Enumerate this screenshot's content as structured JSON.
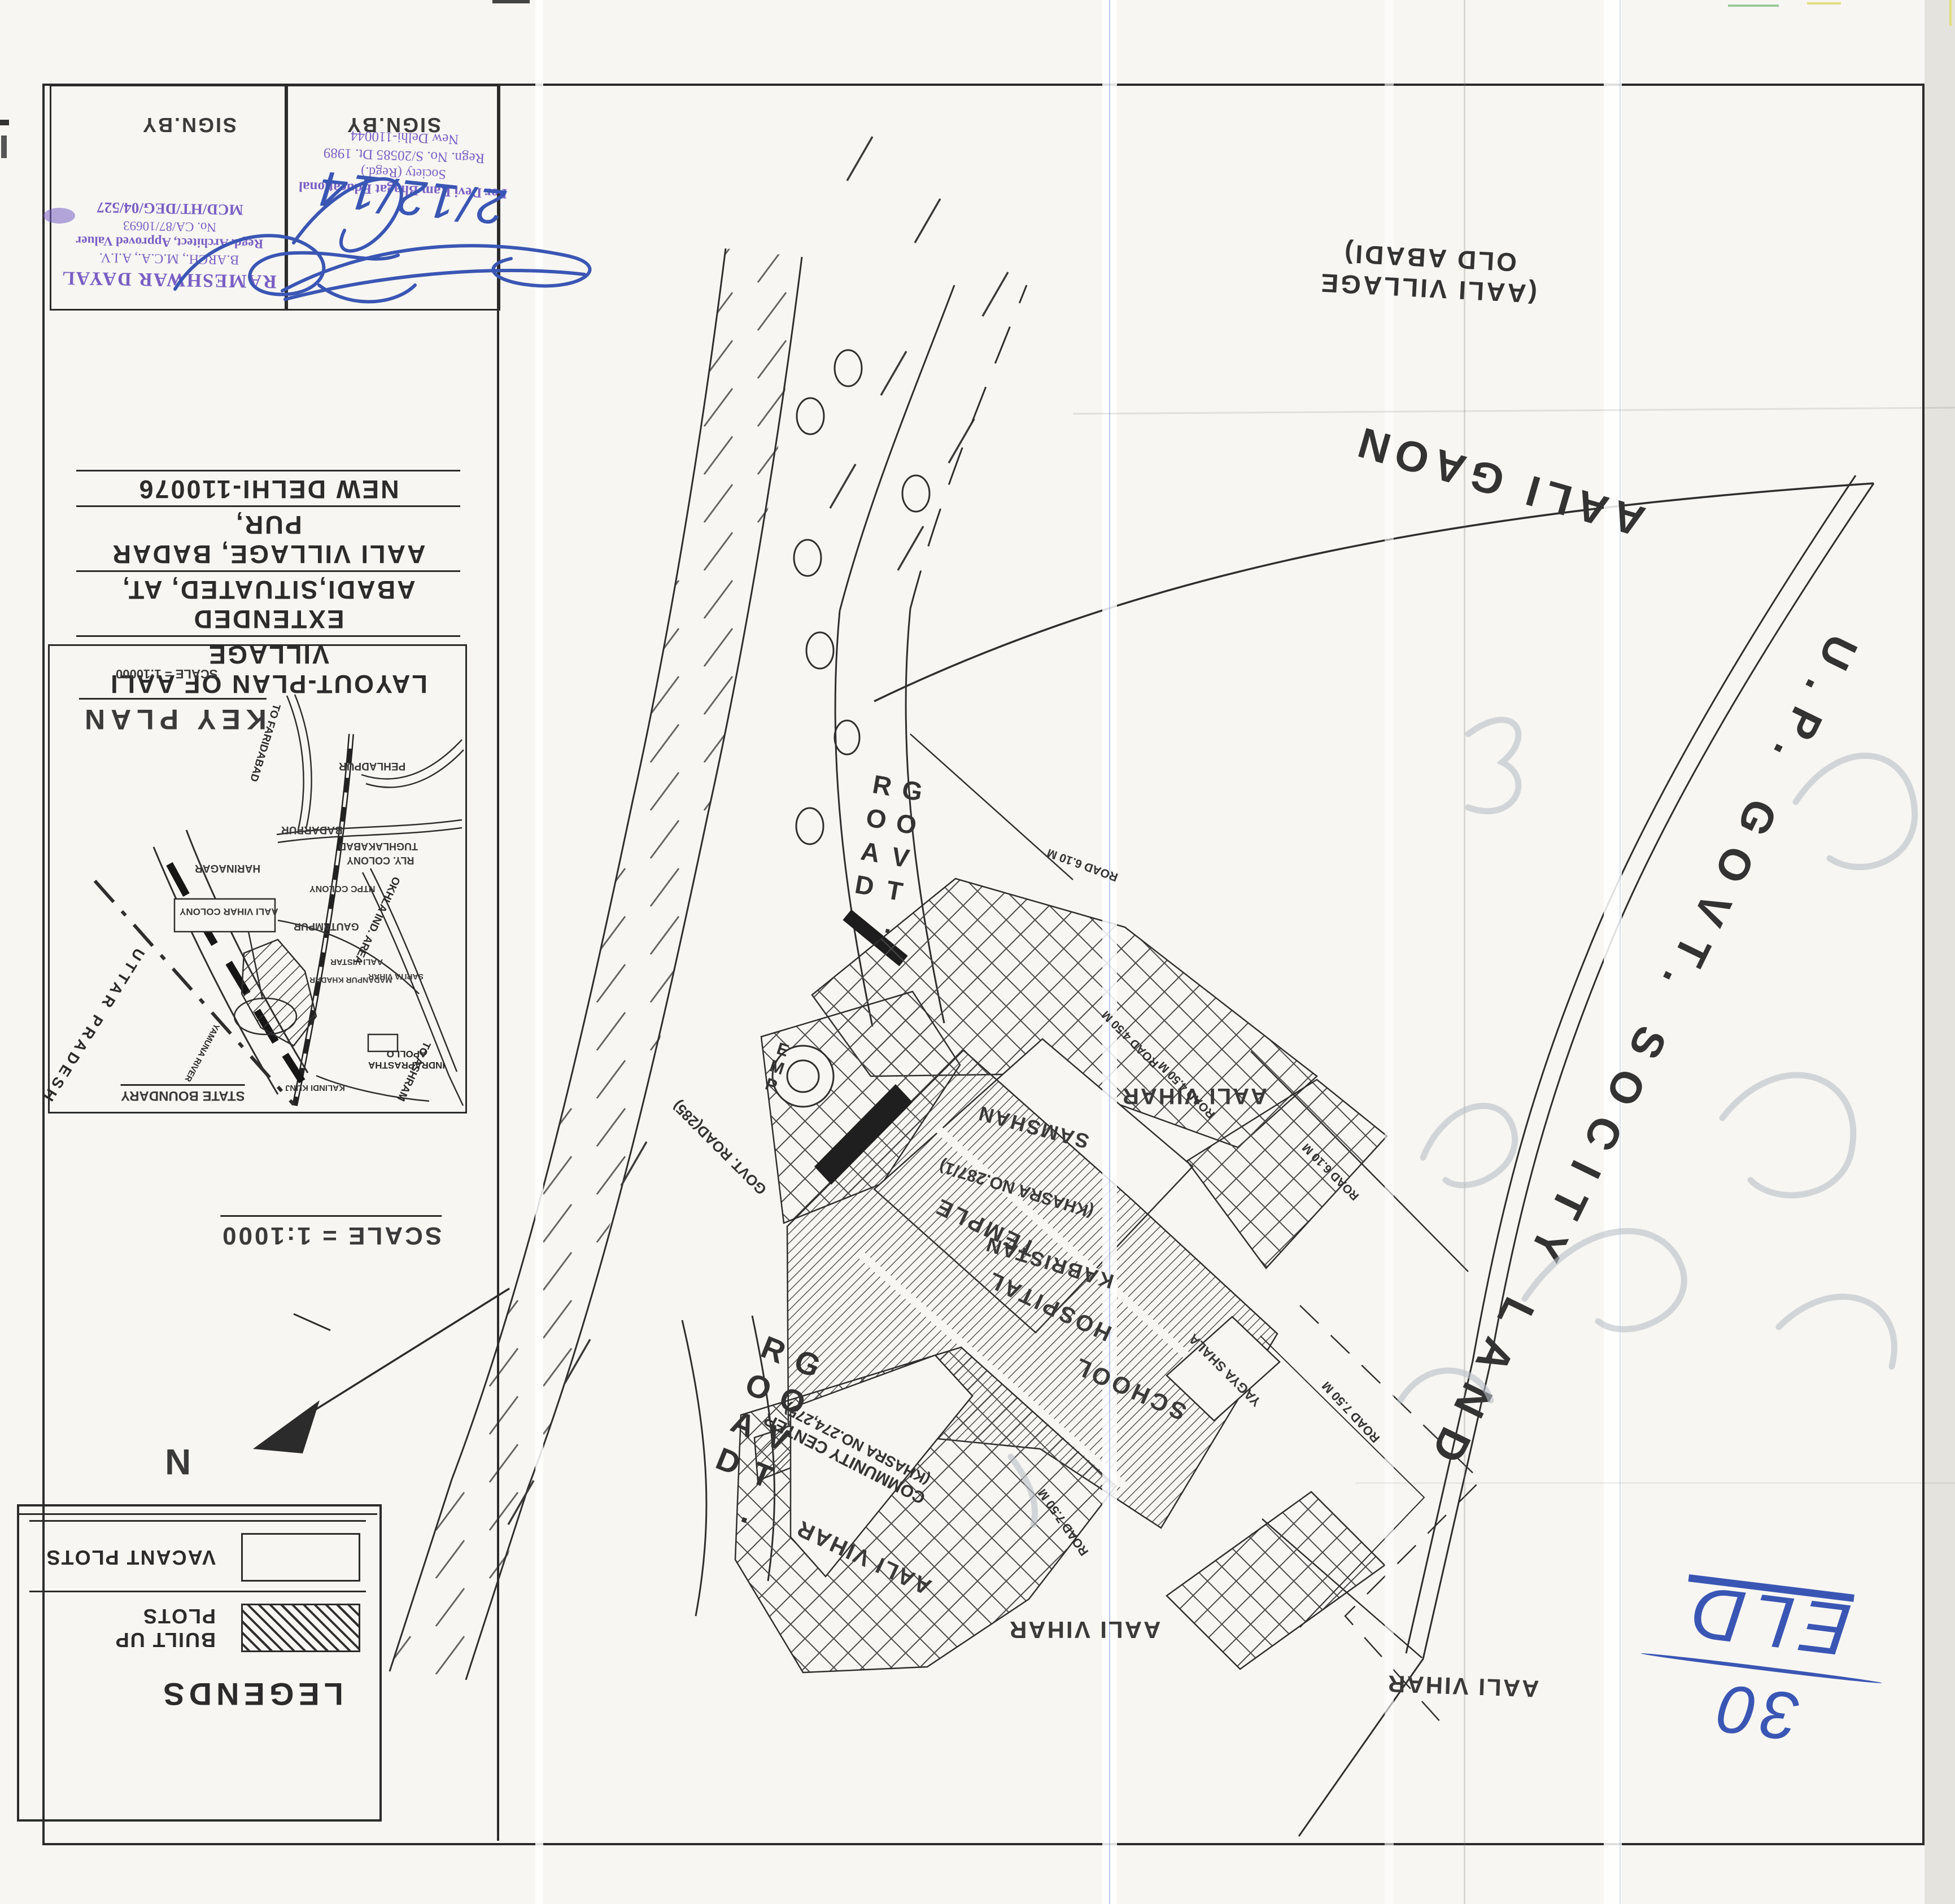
{
  "title_block": {
    "lines": [
      "LAYOUT-PLAN OF AALI VILLAGE",
      "EXTENDED ABADI,SITUATED, AT,",
      "AALI VILLAGE, BADAR PUR,",
      "NEW DELHI-110076"
    ]
  },
  "sign_boxes": {
    "label": "SIGN.BY",
    "architect_stamp": [
      "RAMESHWAR DAYAL",
      "B.ARCH., M.C.A., A.I.V.",
      "Regd. Architect, Approved Valuer",
      "No. CA/87/10693",
      "MCD/HT/DEG/04/527"
    ],
    "society_stamp": [
      "For Devi Ram Bhagat Educational",
      "Society (Regd.)",
      "Regn. No. S/20585 Dt. 1989",
      "New Delhi-110044"
    ],
    "handwritten_date": "2/12/14"
  },
  "key_plan": {
    "title": "KEY PLAN",
    "scale": "SCALE = 1:10000",
    "places": {
      "to_faridabad": "TO FARIDABAD",
      "pehladpur": "PEHLADPUR",
      "badarpur": "BADARPUR",
      "tughlakabad": "TUGHLAKABAD",
      "rly_colony": "RLY. COLONY",
      "harinagar": "HARINAGAR",
      "ntpc_colony": "NTPC COLONY",
      "gautampur": "GAUTAMPUR",
      "aali_vistar": "AALI VISTAR",
      "madanpur_khadar": "MADANPUR KHADAR",
      "sarita_vihar": "SARITA VIHAR",
      "okhla": "OKHLA IND. AREA",
      "yamuna_river": "YAMUNA RIVER",
      "kalindi_kunj": "KALINDI KUNJ",
      "indraprastha": "INDRAPRASTHA",
      "apollo": "APOLLO",
      "to_ashram": "TO ASHRAM",
      "uttar_pradesh": "UTTAR PRADESH",
      "state_boundary": "STATE BOUNDARY",
      "aali_vihar_colony": "AALI VIHAR COLONY"
    }
  },
  "scale_note": "SCALE = 1:1000",
  "north_label": "N",
  "legends": {
    "title": "LEGENDS",
    "built": "BUILT UP PLOTS",
    "vacant": "VACANT PLOTS"
  },
  "map": {
    "govt_road": "GOVT. ROAD",
    "aali_gaon": "AALI GAON",
    "old_abadi_1": "(AALI VILLAGE",
    "old_abadi_2": "OLD ABADI)",
    "up_govt_land": "U.P. GOVT. SOCITY LAND",
    "samshan": "SAMSHAN",
    "khasra_287": "(KHASRA NO.287/1)",
    "kabristan": "KABRISTAN",
    "temple": "TEMPLE",
    "hospital": "HOSPITAL",
    "school": "SCHOOL",
    "yagya_shala": "YAGYA SHALA",
    "community_center": "COMMUNITY CENTER",
    "khasra_274": "(KHASRA NO.274,275)",
    "emp": "EMP",
    "govt_road_285": "GOVT. ROAD(285)",
    "aali_vihar": "AALI VIHAR",
    "road_750": "ROAD 7.50 M",
    "road_610": "ROAD 6.10 M",
    "road_450": "ROAD 4.50 M"
  },
  "annotations": {
    "blue_top": "ELD",
    "blue_bottom": "30"
  },
  "colors": {
    "stamp_purple": "#7a5fc5",
    "pen_blue": "#3a56b4",
    "pencil": "#b9c0c7",
    "ink": "#2b2b2b",
    "paper": "#f7f6f2"
  }
}
